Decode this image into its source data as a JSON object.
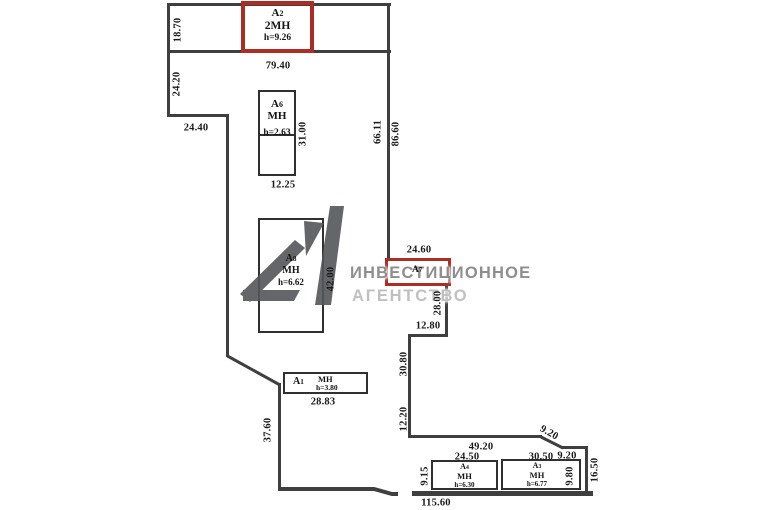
{
  "watermark": {
    "line1": "ИНВЕСТИЦИОННОЕ",
    "line2": "АГЕНТСТВО",
    "logo": "a1-monogram-logo"
  },
  "rooms": {
    "a2": {
      "letter": "А",
      "num": "2",
      "type": "2МН",
      "height": "h=9.26",
      "highlighted": true
    },
    "a6": {
      "letter": "А",
      "num": "6",
      "type": "МН",
      "height": "h=2.63"
    },
    "a8": {
      "letter": "А",
      "num": "8",
      "type": "МН",
      "height": "h=6.62"
    },
    "a7": {
      "letter": "А",
      "num": "7",
      "highlighted": true
    },
    "a1": {
      "letter": "А",
      "num": "1",
      "type": "МН",
      "height": "h=3.80"
    },
    "a4": {
      "letter": "А",
      "num": "4",
      "type": "МН",
      "height": "h=6.30"
    },
    "a3": {
      "letter": "А",
      "num": "3",
      "type": "МН",
      "height": "h=6.77"
    }
  },
  "dimensions": {
    "strip_height": "18.70",
    "strip_width": "79.40",
    "left_upper": "24.20",
    "left_step": "24.40",
    "a6_right": "31.00",
    "a6_bottom": "12.25",
    "right_wall_inner": "66.11",
    "right_wall_outer": "86.60",
    "a8_right": "42.00",
    "a7_top": "24.60",
    "a7_below": "28.00",
    "step_mid": "12.80",
    "mid_right_upper": "30.80",
    "mid_right_lower": "12.20",
    "a1_bottom": "28.83",
    "left_lower": "37.60",
    "br_top": "49.20",
    "a4_top": "24.50",
    "a3_top": "30.50",
    "br_slant": "9.20",
    "br_right_top": "9.20",
    "br_right_side": "16.50",
    "a4_left": "9.15",
    "a3_right": "9.80",
    "bottom_total": "115.60"
  },
  "colors": {
    "wall": "#3f3f3f",
    "highlight_red": "#ab2d24",
    "watermark_dark": "#8e8e8e",
    "watermark_light": "#c0c0c0",
    "logo_gray": "#55565a",
    "text": "#1a1a1a"
  }
}
